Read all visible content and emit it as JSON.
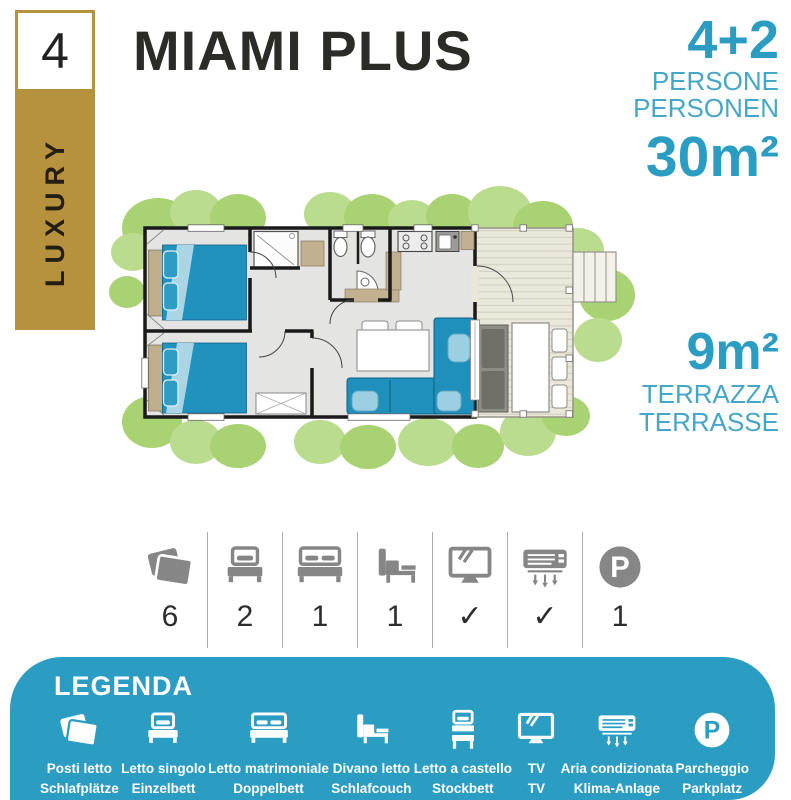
{
  "badge": {
    "number": "4",
    "category": "LUXURY"
  },
  "title": "MIAMI PLUS",
  "capacity": {
    "value": "4+2",
    "line1": "PERSONE",
    "line2": "PERSONEN",
    "area": "30m²"
  },
  "terrace": {
    "area": "9m²",
    "line1": "TERRAZZA",
    "line2": "TERRASSE"
  },
  "amenities": {
    "items": [
      {
        "icon": "pillows",
        "value": "6"
      },
      {
        "icon": "single-bed",
        "value": "2"
      },
      {
        "icon": "double-bed",
        "value": "1"
      },
      {
        "icon": "sofa-bed",
        "value": "1"
      },
      {
        "icon": "tv",
        "value": "✓"
      },
      {
        "icon": "air-conditioning",
        "value": "✓"
      },
      {
        "icon": "parking",
        "value": "1"
      }
    ]
  },
  "legend": {
    "title": "LEGENDA",
    "items": [
      {
        "icon": "pillows",
        "label_it": "Posti letto",
        "label_de": "Schlafplätze"
      },
      {
        "icon": "single-bed",
        "label_it": "Letto singolo",
        "label_de": "Einzelbett"
      },
      {
        "icon": "double-bed",
        "label_it": "Letto matrimoniale",
        "label_de": "Doppelbett"
      },
      {
        "icon": "sofa-bed",
        "label_it": "Divano letto",
        "label_de": "Schlafcouch"
      },
      {
        "icon": "bunk-bed",
        "label_it": "Letto a castello",
        "label_de": "Stockbett"
      },
      {
        "icon": "tv",
        "label_it": "TV",
        "label_de": "TV"
      },
      {
        "icon": "air-conditioning",
        "label_it": "Aria condizionata",
        "label_de": "Klima-Anlage"
      },
      {
        "icon": "parking",
        "label_it": "Parcheggio",
        "label_de": "Parkplatz"
      }
    ]
  },
  "colors": {
    "accent_blue": "#2B9DC3",
    "subtitle_blue": "#45A7C8",
    "gold": "#B6923E",
    "icon_gray": "#868686",
    "text_dark": "#2B2B28",
    "bed_blue": "#2191BD",
    "bush_green": "#A9D273",
    "deck_beige": "#EAE7DB"
  }
}
